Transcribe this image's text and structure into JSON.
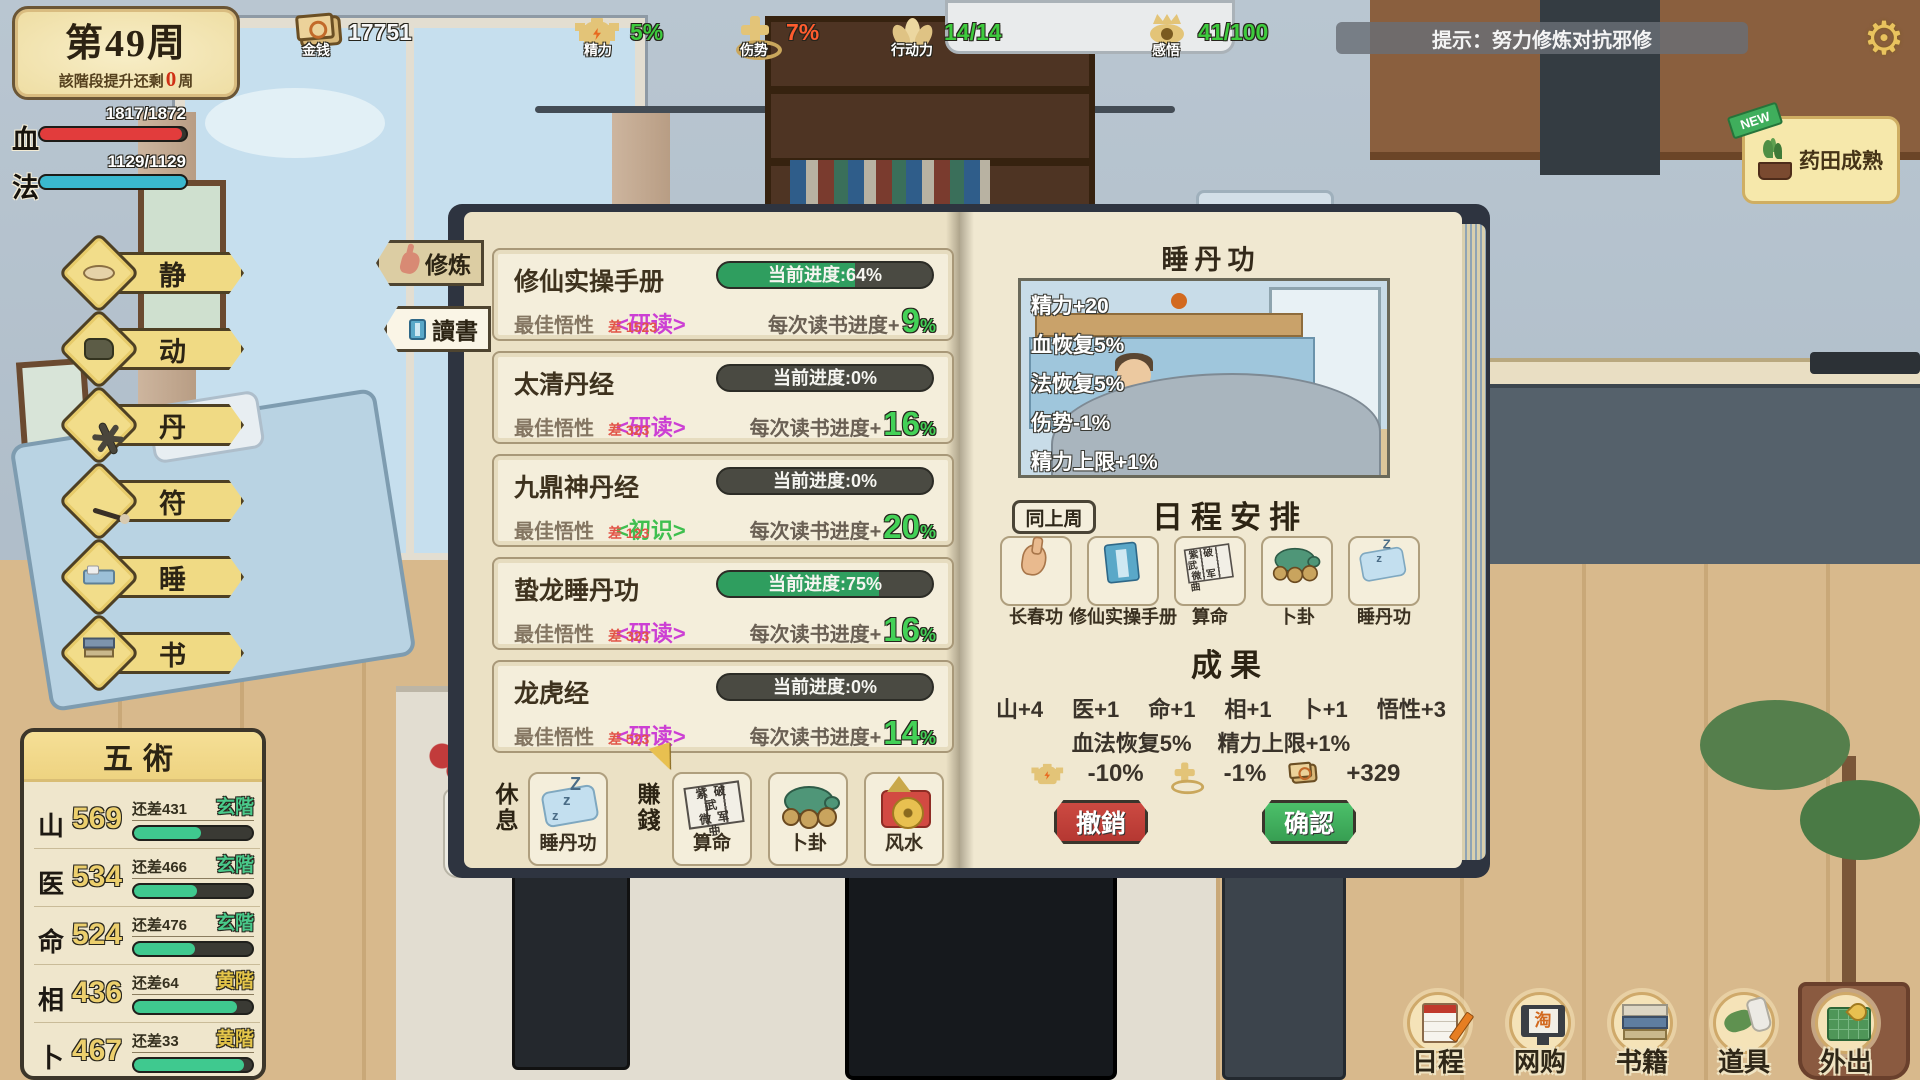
{
  "week": {
    "title": "第49周",
    "sub_prefix": "該階段提升还剩",
    "sub_value": "0",
    "sub_suffix": "周"
  },
  "vitals": {
    "hp": {
      "label": "血",
      "value": "1817/1872",
      "pct": 97,
      "color": "#e23c3c"
    },
    "mp": {
      "label": "法",
      "value": "1129/1129",
      "pct": 100,
      "color": "#3ab8cf"
    }
  },
  "top_stats": [
    {
      "name": "money",
      "label": "金钱",
      "value": "17751",
      "color": "#f7f7f7"
    },
    {
      "name": "energy",
      "label": "精力",
      "value": "5%",
      "color": "#3ecb3e"
    },
    {
      "name": "injury",
      "label": "伤势",
      "value": "7%",
      "color": "#ff5c2e"
    },
    {
      "name": "action",
      "label": "行动力",
      "value": "14/14",
      "color": "#3ecb3e"
    },
    {
      "name": "insight",
      "label": "感悟",
      "value": "41/100",
      "color": "#3ecb3e"
    }
  ],
  "hint": {
    "text": "提示：努力修炼对抗邪修"
  },
  "notification": {
    "badge": "NEW",
    "text": "药田成熟"
  },
  "left_menu": [
    {
      "label": "静"
    },
    {
      "label": "动"
    },
    {
      "label": "丹"
    },
    {
      "label": "符"
    },
    {
      "label": "睡"
    },
    {
      "label": "书"
    }
  ],
  "five_arts": {
    "title": "五術",
    "rows": [
      {
        "glyph": "山",
        "value": "569",
        "remain": "还差431",
        "rank": "玄階",
        "rank_color": "#49c98a",
        "pct": 57
      },
      {
        "glyph": "医",
        "value": "534",
        "remain": "还差466",
        "rank": "玄階",
        "rank_color": "#49c98a",
        "pct": 53
      },
      {
        "glyph": "命",
        "value": "524",
        "remain": "还差476",
        "rank": "玄階",
        "rank_color": "#49c98a",
        "pct": 52
      },
      {
        "glyph": "相",
        "value": "436",
        "remain": "还差64",
        "rank": "黄階",
        "rank_color": "#e5c64a",
        "pct": 87
      },
      {
        "glyph": "卜",
        "value": "467",
        "remain": "还差33",
        "rank": "黄階",
        "rank_color": "#e5c64a",
        "pct": 93
      }
    ]
  },
  "book": {
    "tabs": [
      {
        "label": "修炼"
      },
      {
        "label": "讀書"
      }
    ],
    "entries": [
      {
        "title": "修仙实操手册",
        "progress_text": "当前进度:64%",
        "progress_pct": 64,
        "best_label": "最佳悟性",
        "best_value": "2000",
        "diff": "差 1523",
        "mode": "<研读>",
        "mode_color": "#cc3fd4",
        "gain_label": "每次读书进度+",
        "gain_value": "9",
        "gain_unit": "%"
      },
      {
        "title": "太清丹经",
        "progress_text": "当前进度:0%",
        "progress_pct": 0,
        "best_label": "最佳悟性",
        "best_value": "800",
        "diff": "差 323",
        "mode": "<研读>",
        "mode_color": "#cc3fd4",
        "gain_label": "每次读书进度+",
        "gain_value": "16",
        "gain_unit": "%"
      },
      {
        "title": "九鼎神丹经",
        "progress_text": "当前进度:0%",
        "progress_pct": 0,
        "best_label": "最佳悟性",
        "best_value": "600",
        "diff": "差 123",
        "mode": "<初识>",
        "mode_color": "#3fbf4f",
        "gain_label": "每次读书进度+",
        "gain_value": "20",
        "gain_unit": "%"
      },
      {
        "title": "蛰龙睡丹功",
        "progress_text": "当前进度:75%",
        "progress_pct": 75,
        "best_label": "最佳悟性",
        "best_value": "800",
        "diff": "差 323",
        "mode": "<研读>",
        "mode_color": "#cc3fd4",
        "gain_label": "每次读书进度+",
        "gain_value": "16",
        "gain_unit": "%"
      },
      {
        "title": "龙虎经",
        "progress_text": "当前进度:0%",
        "progress_pct": 0,
        "best_label": "最佳悟性",
        "best_value": "1000",
        "diff": "差 523",
        "mode": "<研读>",
        "mode_color": "#cc3fd4",
        "gain_label": "每次读书进度+",
        "gain_value": "14",
        "gain_unit": "%"
      }
    ],
    "rest": {
      "label": "休息",
      "cards": [
        {
          "label": "睡丹功"
        }
      ]
    },
    "earn": {
      "label": "賺錢",
      "cards": [
        {
          "label": "算命"
        },
        {
          "label": "卜卦"
        },
        {
          "label": "风水"
        }
      ]
    },
    "fortune_grid": {
      "row1": "紫破武",
      "row2": "微军曲"
    },
    "zs": {
      "big": "Z",
      "small": "z"
    },
    "right": {
      "title": "睡丹功",
      "effects": [
        "精力+20",
        "血恢复5%",
        "法恢复5%",
        "伤势-1%",
        "精力上限+1%"
      ],
      "same_week": "同上周",
      "schedule_title": "日程安排",
      "schedule_cards": [
        {
          "label": "长春功"
        },
        {
          "label": "修仙实操手册"
        },
        {
          "label": "算命"
        },
        {
          "label": "卜卦"
        },
        {
          "label": "睡丹功"
        }
      ],
      "results_title": "成果",
      "stats": [
        "山+4",
        "医+1",
        "命+1",
        "相+1",
        "卜+1",
        "悟性+3"
      ],
      "bonus": [
        "血法恢复5%",
        "精力上限+1%"
      ],
      "costs": [
        {
          "icon": "energy",
          "value": "-10%"
        },
        {
          "icon": "injury",
          "value": "-1%"
        },
        {
          "icon": "money",
          "value": "+329"
        }
      ],
      "cancel": "撤銷",
      "confirm": "确認"
    }
  },
  "bottom_nav": [
    {
      "label": "日程"
    },
    {
      "label": "网购",
      "screen_char": "淘"
    },
    {
      "label": "书籍"
    },
    {
      "label": "道具"
    },
    {
      "label": "外出"
    }
  ]
}
